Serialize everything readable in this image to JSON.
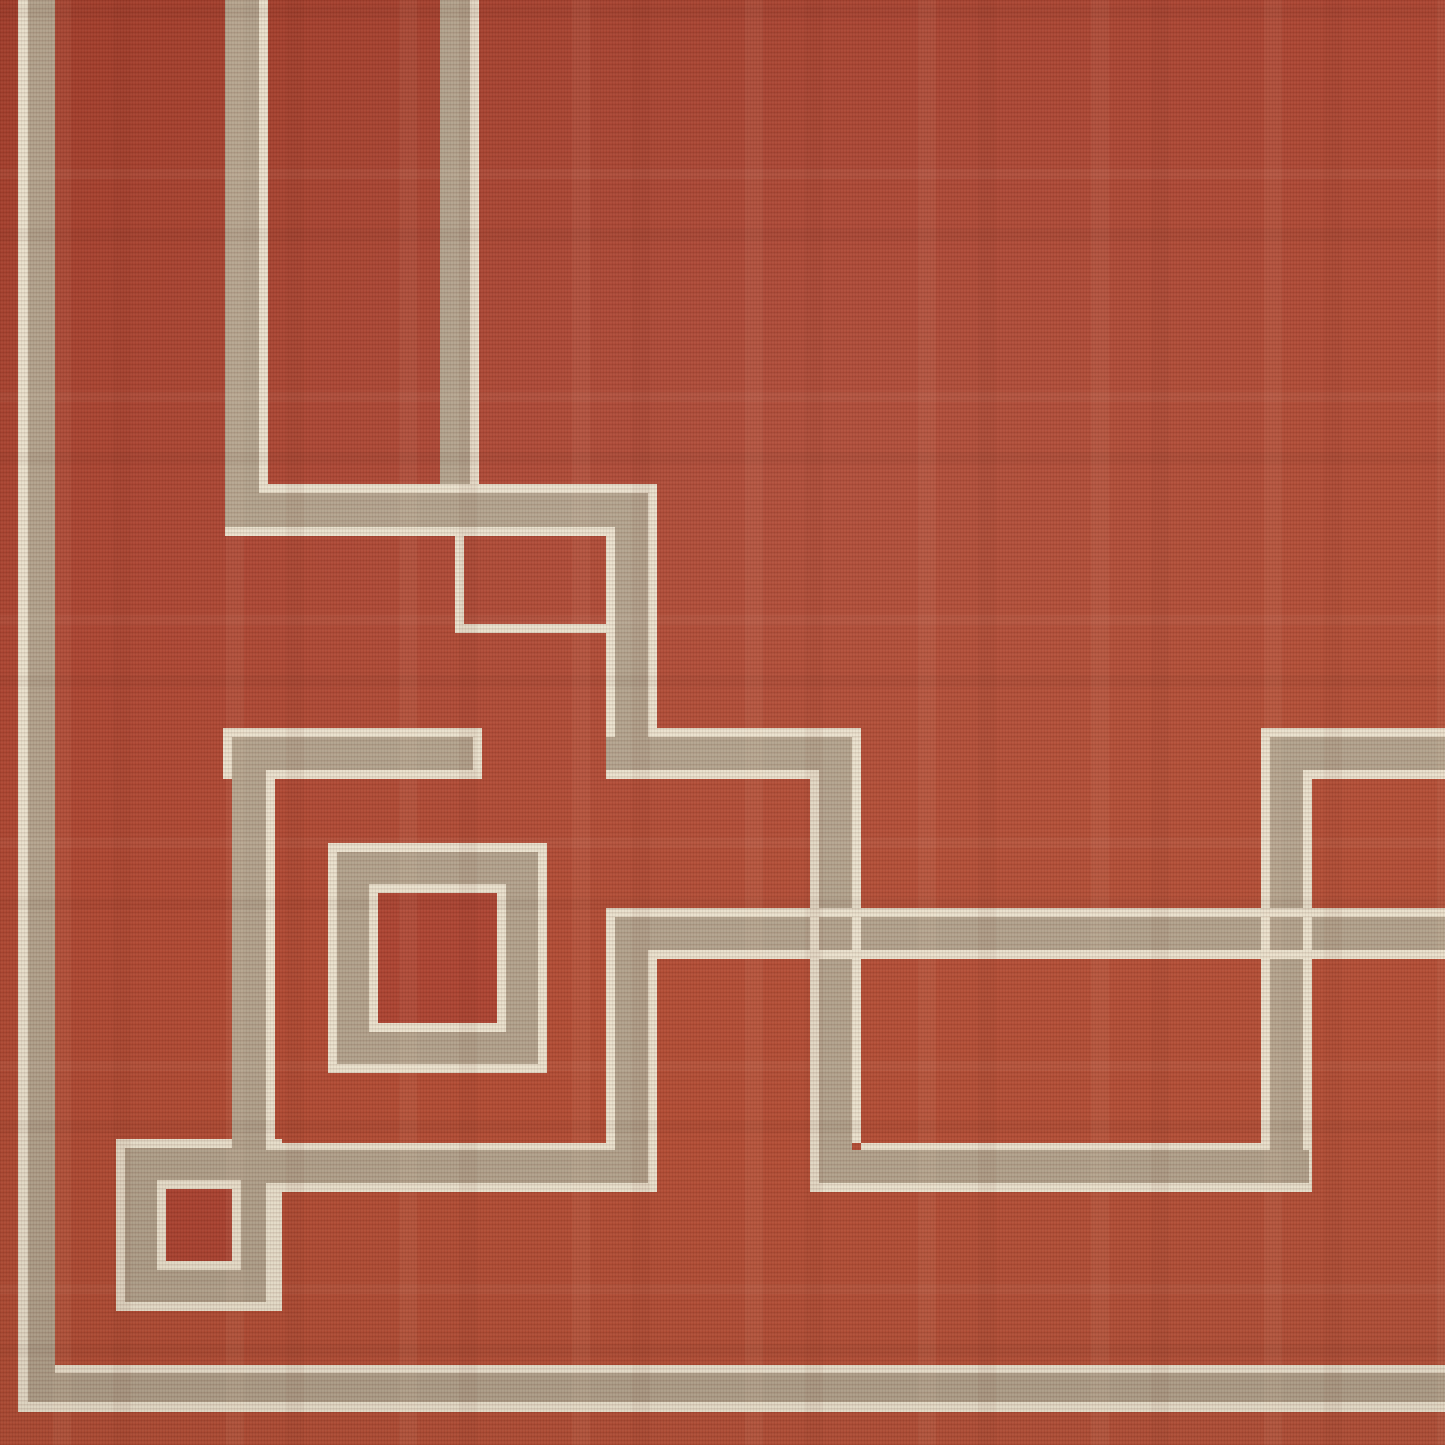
{
  "image": {
    "type": "rug-product-photo",
    "description": "Close-up corner detail of a rust-red flat-weave area rug with a taupe Greek-key fret pattern outlined by cream pinstripes",
    "width": 1445,
    "height": 1445
  },
  "colors": {
    "field_red": "#ad4230",
    "field_red_light": "#b55038",
    "field_red_dark": "#a23c2a",
    "band_tan": "#b2a28c",
    "pinstripe_cream": "#eae1cd"
  },
  "pattern": {
    "cream_rects": [
      [
        18,
        0,
        10,
        1412,
        "left-border-outer-cream"
      ],
      [
        55,
        1365,
        1390,
        8,
        "bottom-border-inner-cream"
      ],
      [
        18,
        1402,
        1427,
        10,
        "bottom-border-outer-cream"
      ],
      [
        259,
        0,
        9,
        493,
        "v1-right-cream"
      ],
      [
        470,
        0,
        9,
        484,
        "v2-right-cream"
      ],
      [
        259,
        484,
        389,
        9,
        "band-a-top-cream"
      ],
      [
        225,
        527,
        390,
        9,
        "band-a-bottom-cream"
      ],
      [
        648,
        484,
        9,
        244,
        "v-ab-right-cream"
      ],
      [
        606,
        527,
        9,
        210,
        "v-ab-left-cream"
      ],
      [
        648,
        728,
        213,
        9,
        "band-b-top-cream"
      ],
      [
        606,
        770,
        204,
        9,
        "band-b-bottom-cream"
      ],
      [
        852,
        728,
        9,
        415,
        "v6-right-cream"
      ],
      [
        810,
        770,
        9,
        422,
        "v6-left-cream"
      ],
      [
        861,
        1143,
        400,
        9,
        "h2-top-cream"
      ],
      [
        810,
        1183,
        502,
        9,
        "h2-bottom-cream"
      ],
      [
        1261,
        728,
        9,
        424,
        "v4-left-cream"
      ],
      [
        1303,
        777,
        9,
        415,
        "v4-right-cream"
      ],
      [
        1270,
        728,
        175,
        9,
        "band-r-top-cream"
      ],
      [
        1303,
        770,
        142,
        9,
        "band-r-bottom-cream"
      ],
      [
        606,
        908,
        839,
        9,
        "band-c-top-cream"
      ],
      [
        657,
        950,
        788,
        9,
        "band-c-bottom-cream"
      ],
      [
        606,
        917,
        9,
        226,
        "v5-left-cream"
      ],
      [
        648,
        950,
        9,
        242,
        "v5-right-cream"
      ],
      [
        282,
        1143,
        333,
        9,
        "h-top-cream"
      ],
      [
        282,
        1183,
        375,
        9,
        "h-bottom-cream"
      ],
      [
        232,
        728,
        250,
        9,
        "band-b2-top-cream"
      ],
      [
        275,
        770,
        207,
        9,
        "band-b2-bottom-cream"
      ],
      [
        473,
        728,
        9,
        51,
        "band-b2-end-cap-cream"
      ],
      [
        223,
        728,
        9,
        51,
        "band-b2-west-cap-cream"
      ],
      [
        266,
        770,
        9,
        369,
        "v3-right-cream"
      ],
      [
        116,
        1139,
        166,
        172,
        "small-square-outer-cream"
      ],
      [
        328,
        843,
        219,
        230,
        "big-square-outer-cream"
      ],
      [
        455,
        536,
        9,
        97,
        "step-line-vertical-cream"
      ],
      [
        455,
        624,
        160,
        9,
        "step-line-horizontal-cream"
      ]
    ],
    "tan_rects": [
      [
        28,
        0,
        27,
        1402,
        "left-border-tan"
      ],
      [
        28,
        1373,
        1417,
        29,
        "bottom-border-tan"
      ],
      [
        225,
        0,
        34,
        527,
        "v1-tan"
      ],
      [
        440,
        0,
        30,
        484,
        "v2-tan"
      ],
      [
        225,
        493,
        423,
        34,
        "band-a-tan"
      ],
      [
        615,
        493,
        33,
        277,
        "v-ab-tan"
      ],
      [
        606,
        737,
        246,
        33,
        "band-b-tan"
      ],
      [
        819,
        737,
        33,
        446,
        "v6-tan"
      ],
      [
        819,
        1150,
        490,
        33,
        "h2-tan"
      ],
      [
        1270,
        737,
        33,
        446,
        "v4-tan"
      ],
      [
        1270,
        737,
        175,
        33,
        "band-r-tan"
      ],
      [
        615,
        917,
        830,
        33,
        "band-c-tan"
      ],
      [
        615,
        917,
        33,
        266,
        "v5-tan"
      ],
      [
        266,
        1150,
        349,
        33,
        "h-tan"
      ],
      [
        232,
        737,
        241,
        33,
        "band-b2-tan"
      ],
      [
        232,
        737,
        34,
        565,
        "v3-and-small-square-right-bar-tan"
      ],
      [
        125,
        1148,
        141,
        154,
        "small-square-ring-tan"
      ],
      [
        337,
        852,
        201,
        212,
        "big-square-ring-tan"
      ]
    ],
    "overlay_cream_rects": [
      [
        157,
        1180,
        84,
        90,
        "small-square-inner-cream"
      ],
      [
        369,
        884,
        137,
        148,
        "big-square-inner-cream"
      ],
      [
        819,
        908,
        33,
        9,
        "band-c-top-cream-over-v6"
      ],
      [
        819,
        950,
        33,
        9,
        "band-c-bottom-cream-over-v6"
      ],
      [
        1270,
        908,
        33,
        9,
        "band-c-top-cream-over-v4"
      ],
      [
        1270,
        950,
        33,
        9,
        "band-c-bottom-cream-over-v4"
      ],
      [
        810,
        917,
        9,
        33,
        "v6-left-cream-over-band-c"
      ],
      [
        852,
        917,
        9,
        33,
        "v6-right-cream-over-band-c"
      ],
      [
        1261,
        917,
        9,
        33,
        "v4-left-cream-over-band-c"
      ],
      [
        1303,
        917,
        9,
        33,
        "v4-right-cream-over-band-c"
      ]
    ],
    "inner_red_rects": [
      [
        166,
        1189,
        66,
        72,
        "small-square-center-red"
      ],
      [
        378,
        893,
        119,
        130,
        "big-square-center-red"
      ]
    ]
  }
}
